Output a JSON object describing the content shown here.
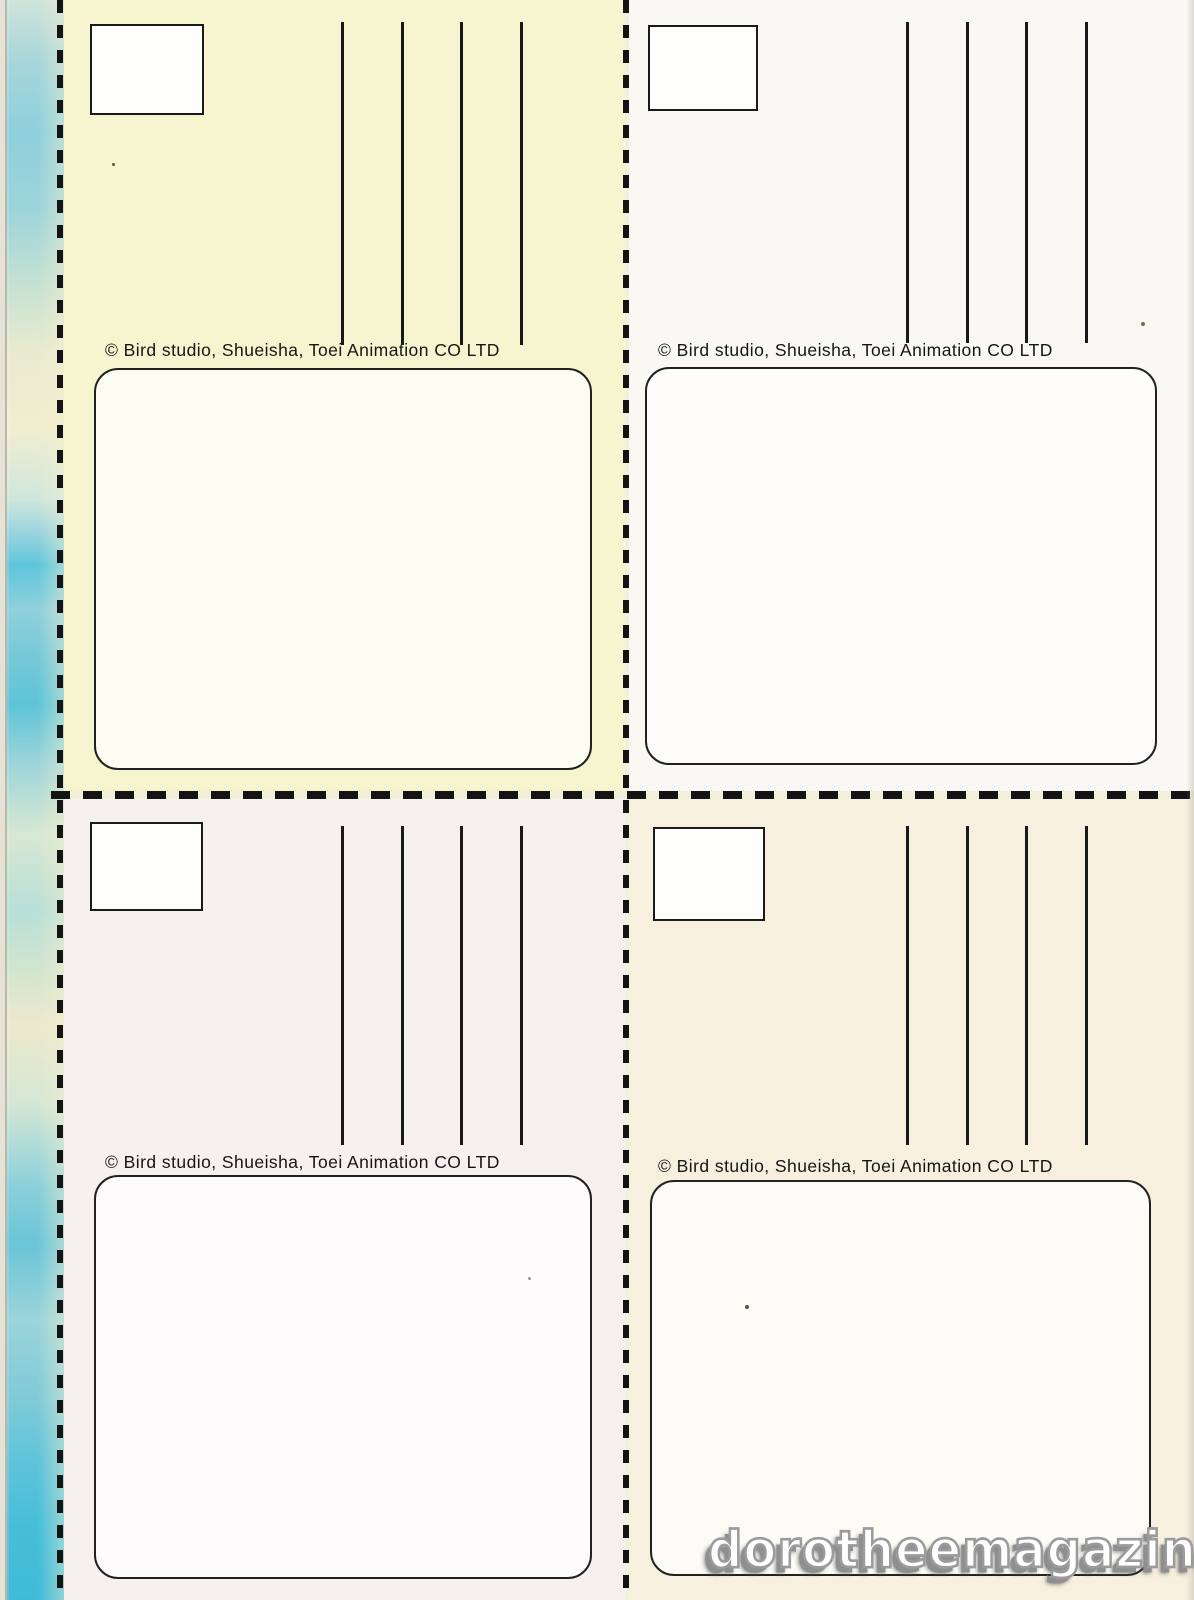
{
  "page": {
    "watermark_text": "dorotheemagazine.fr"
  },
  "cards": [
    {
      "name": "postcard-back-top-left",
      "copyright": "© Bird studio, Shueisha, Toei Animation CO LTD",
      "bg": "#f7f5cf",
      "bg_style": "background-color:#f7f5cf"
    },
    {
      "name": "postcard-back-top-right",
      "copyright": "© Bird studio, Shueisha, Toei Animation CO LTD",
      "bg": "#f9f8f3",
      "bg_style": "background-color:#f9f8f3"
    },
    {
      "name": "postcard-back-bottom-left",
      "copyright": "© Bird studio, Shueisha, Toei Animation CO LTD",
      "bg": "#f6f1ef",
      "bg_style": "background-color:#f6f1ef"
    },
    {
      "name": "postcard-back-bottom-right",
      "copyright": "© Bird studio, Shueisha, Toei Animation CO LTD",
      "bg": "#f7f0df",
      "bg_style": "background-color:#f7f0df"
    }
  ],
  "colors": {
    "ink": "#1a1a1a",
    "strip_blue_strong": "#47bed9",
    "strip_blue_soft": "#9dd4da",
    "strip_cream": "#f0eecf",
    "card_top_left_bg": "#f7f5cf",
    "card_top_right_bg": "#f9f8f3",
    "card_bottom_left_bg": "#f6f1ef",
    "card_bottom_right_bg": "#f7f0df",
    "message_box_fill": "#fdfdfa",
    "watermark_fill": "#ffffff",
    "watermark_shadow": "#8f8f8f"
  }
}
